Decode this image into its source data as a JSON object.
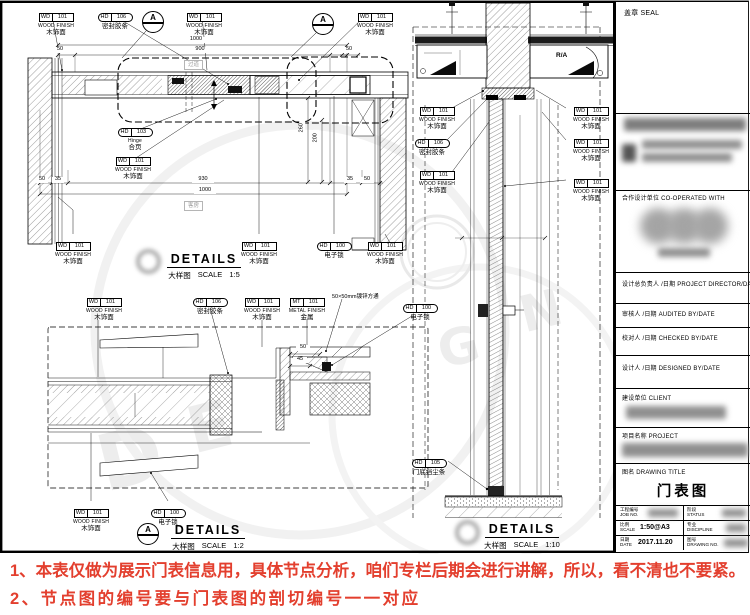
{
  "tags": {
    "wd101": {
      "code": "WD",
      "num": "101",
      "en": "WOOD FINISH",
      "cn": "木饰面"
    },
    "hd106": {
      "code": "HD",
      "num": "106",
      "cn": "密封胶条"
    },
    "hd103": {
      "code": "HD",
      "num": "103",
      "en": "Hinge",
      "cn": "合页"
    },
    "hd100": {
      "code": "HD",
      "num": "100",
      "cn": "电子锁"
    },
    "hd105": {
      "code": "HD",
      "num": "105",
      "cn": "门底挡尘条"
    },
    "mt101": {
      "code": "MT",
      "num": "101",
      "en": "METAL FINISH",
      "cn": "金属"
    },
    "tube": "50×50mm镀锌方通",
    "ra": "R/A"
  },
  "rooms": {
    "corridor": "过道",
    "guest": "客房"
  },
  "marker_a": "A",
  "dims": {
    "d1000": "1000",
    "d900": "900",
    "d930": "930",
    "d50": "50",
    "d35": "35",
    "d45": "45",
    "d260": "260",
    "d200": "200"
  },
  "details": {
    "d1": {
      "en": "DETAILS",
      "cn": "大样图",
      "scale_word": "SCALE",
      "scale": "1:5"
    },
    "d2": {
      "en": "DETAILS",
      "cn": "大样图",
      "scale_word": "SCALE",
      "scale": "1:2"
    },
    "d3": {
      "en": "DETAILS",
      "cn": "大样图",
      "scale_word": "SCALE",
      "scale": "1:10"
    }
  },
  "titleblock": {
    "seal": "盖章 SEAL",
    "cooperated": "合作设计单位 CO-OPERATED WITH",
    "director": "设计总负责人 /日期 PROJECT DIRECTOR/DATE",
    "audited": "审核人 /日期 AUDITED BY/DATE",
    "checked": "校对人 /日期 CHECKED BY/DATE",
    "designed": "设计人 /日期 DESIGNED BY/DATE",
    "client": "建设单位 CLIENT",
    "project": "项目名称 PROJECT",
    "drawing_title_label": "图名 DRAWING TITLE",
    "drawing_title": "门表图",
    "job_cn": "工程编号",
    "job_en": "JOB NO.",
    "status_cn": "阶段",
    "status_en": "STATUS",
    "scale_cn": "比例",
    "scale_en": "SCALE",
    "scale_value": "1:50@A3",
    "disc_cn": "专业",
    "disc_en": "DISCIPLINE",
    "date_cn": "日期",
    "date_en": "DATE",
    "date_value": "2017.11.20",
    "dwg_cn": "图号",
    "dwg_en": "DRAWING NO."
  },
  "notes": {
    "line1": "1、本表仅做为展示门表信息用，具体节点分析，咱们专栏后期会进行讲解，所以，看不清也不要紧。",
    "line2": "2、节点图的编号要与门表图的剖切编号一一对应",
    "color": "#e33f2e"
  },
  "watermark": {
    "l0": "D",
    "l1": "E",
    "l2": "G",
    "l3": "N"
  }
}
